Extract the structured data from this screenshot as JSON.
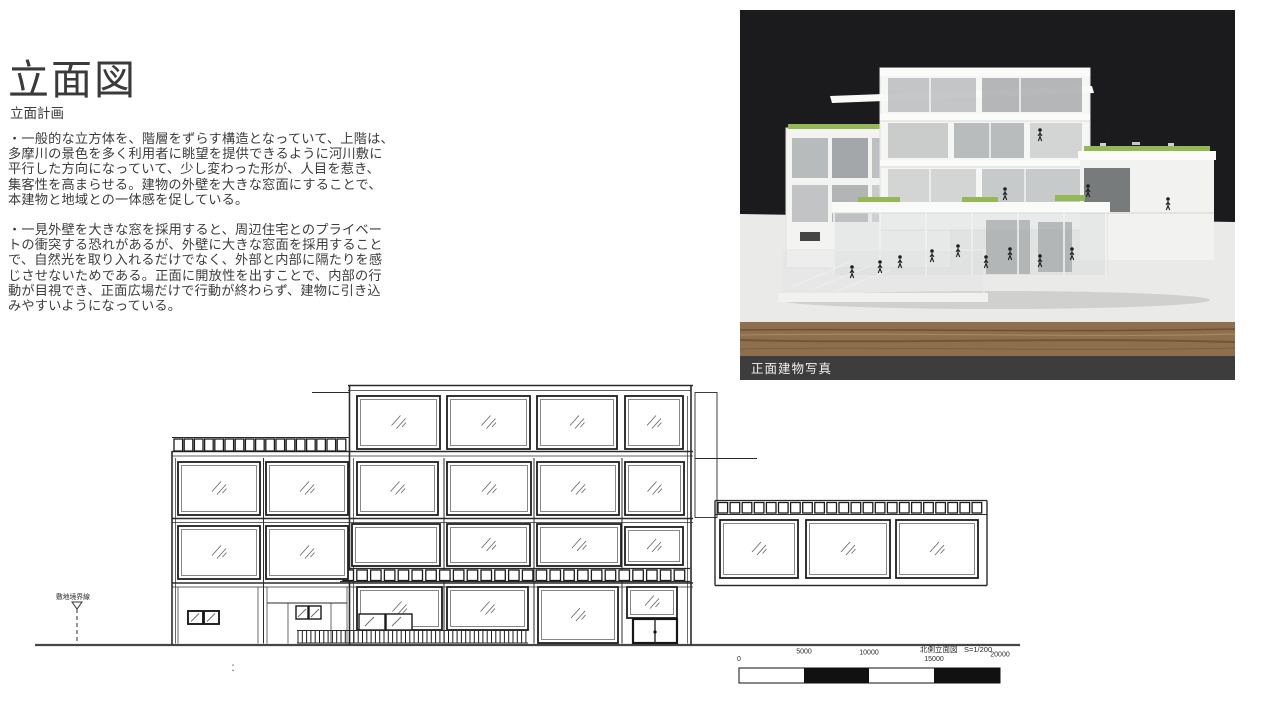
{
  "slide": {
    "background": "#ffffff"
  },
  "header": {
    "title": "立面図",
    "subtitle": "立面計画",
    "paragraph1": "・一般的な立方体を、階層をずらす構造となっていて、上階は、\n多摩川の景色を多く利用者に眺望を提供できるように河川敷に\n平行した方向になっていて、少し変わった形が、人目を惹き、\n集客性を高まらせる。建物の外壁を大きな窓面にすることで、\n本建物と地域との一体感を促している。",
    "paragraph2": "・一見外壁を大きな窓を採用すると、周辺住宅とのプライベー\nトの衝突する恐れがあるが、外壁に大きな窓面を採用すること\nで、自然光を取り入れるだけでなく、外部と内部に隔たりを感\nじさせないためである。正面に開放性を出すことで、内部の行\n動が目視でき、正面広場だけで行動が終わらず、建物に引き込\nみやすいようになっている。"
  },
  "photo": {
    "caption": "正面建物写真",
    "background_color": "#1b1b1d",
    "table_color": "#eaeae8",
    "wood_color": "#8d6f4e",
    "caption_bar_color": "#3d3d3d",
    "model_green_color": "#94b954"
  },
  "drawing": {
    "line_color": "#2b2b2b",
    "site_boundary_label": "敷地境界線",
    "ground_mark": ":",
    "scale_bar": {
      "title": "北側立面図",
      "scale": "S=1/200",
      "ticks": [
        "0",
        "5000",
        "10000",
        "15000",
        "20000"
      ]
    }
  }
}
